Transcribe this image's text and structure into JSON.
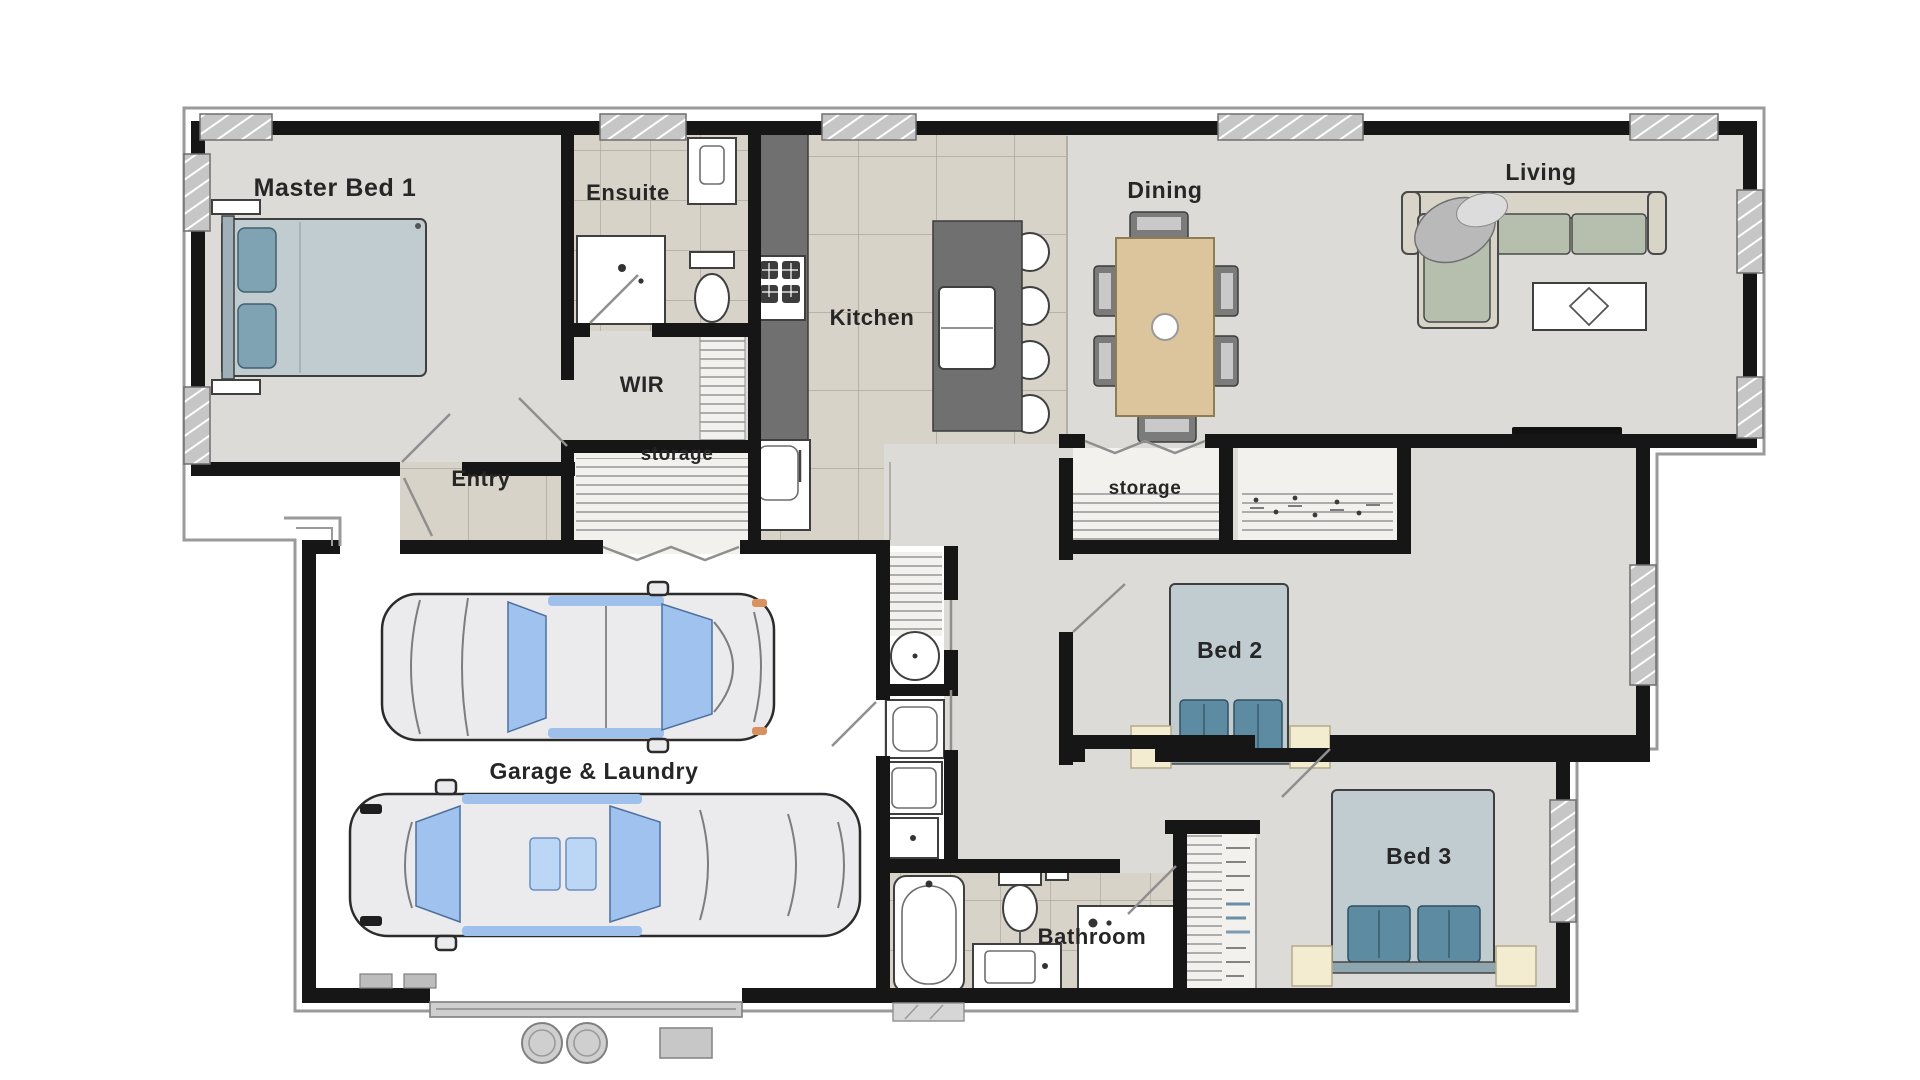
{
  "title": "House floor plan",
  "rooms": {
    "master_bed": {
      "label": "Master Bed 1"
    },
    "ensuite": {
      "label": "Ensuite"
    },
    "wir": {
      "label": "WIR"
    },
    "kitchen": {
      "label": "Kitchen"
    },
    "dining": {
      "label": "Dining"
    },
    "living": {
      "label": "Living"
    },
    "entry": {
      "label": "Entry"
    },
    "storage_hall": {
      "label": "storage"
    },
    "storage_wing": {
      "label": "storage"
    },
    "garage_laundry": {
      "label": "Garage & Laundry"
    },
    "bed2": {
      "label": "Bed 2"
    },
    "bed3": {
      "label": "Bed 3"
    },
    "bathroom": {
      "label": "Bathroom"
    }
  },
  "colors": {
    "wall": "#161616",
    "floor": "#dcdbd7",
    "tile": "#d8d3c8",
    "tile_line": "#a39d90",
    "trim": "#9a9a9a",
    "bench": "#707070",
    "table": "#dcc49c",
    "sofa_cushion": "#b6bfae",
    "sofa_frame": "#d8d5c8",
    "bed": "#c1ccd1",
    "pillow": "#5d8ba2",
    "pillow_master": "#7fa3b2",
    "nightstand": "#f3ecd0",
    "win": "#c6c6c6",
    "car_window": "#9fc2ee",
    "closet_bg": "#f2f1ed",
    "label": "#262626"
  }
}
